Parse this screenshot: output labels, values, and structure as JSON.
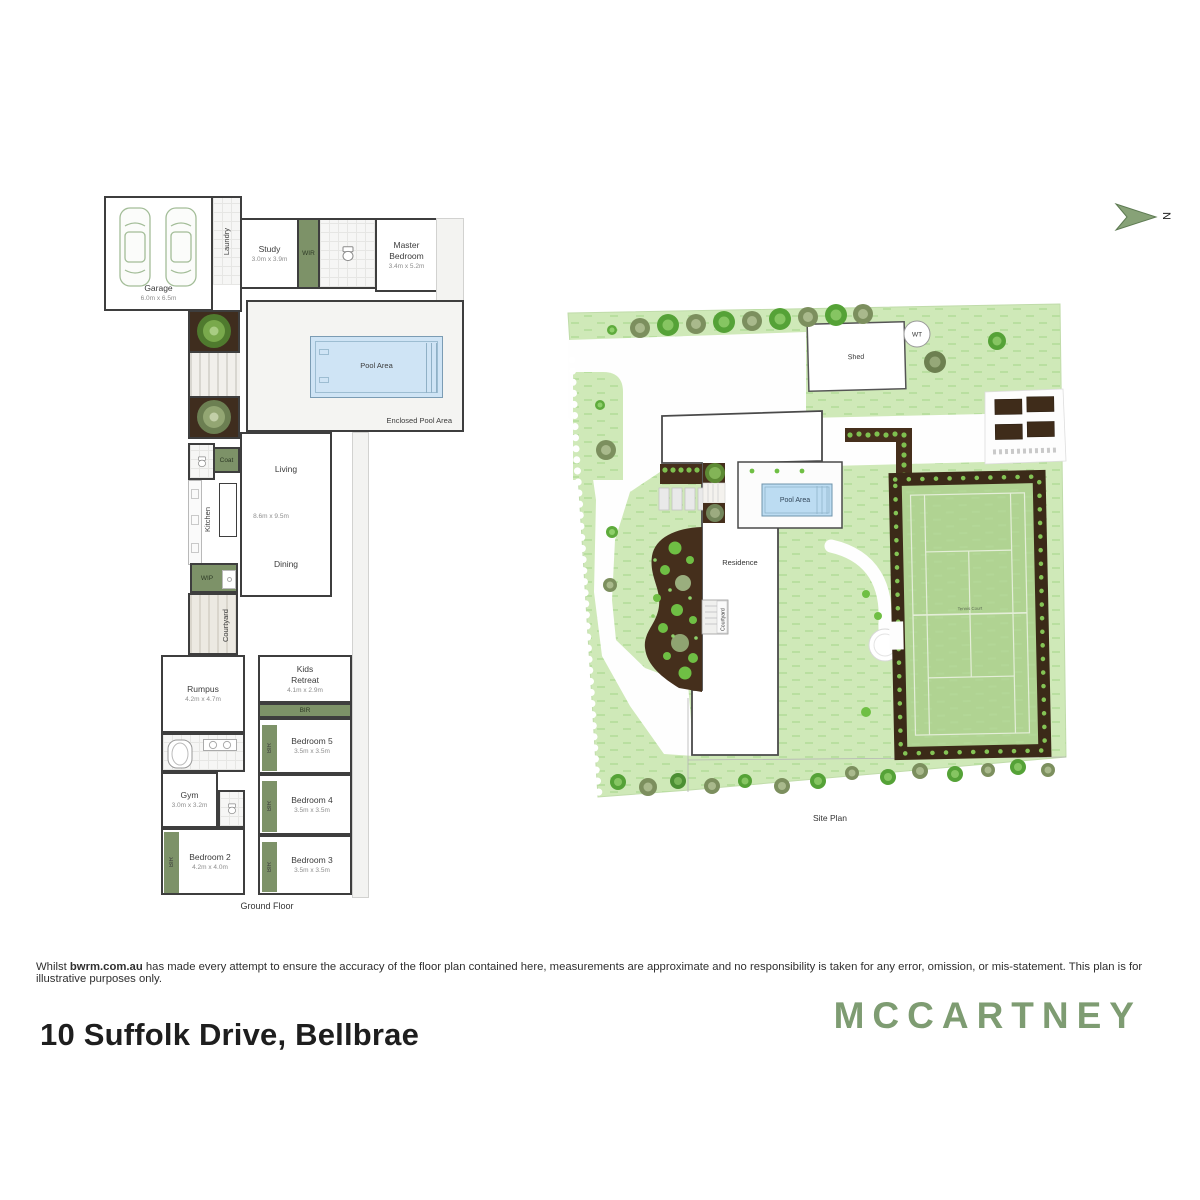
{
  "header": {
    "north_label": "N"
  },
  "floor_plan": {
    "caption": "Ground Floor",
    "labels": {
      "laundry": "Laundry",
      "wir": "WIR",
      "entry": "Entry",
      "pool": "Pool Area",
      "enclosed_pool": "Enclosed Pool Area",
      "coat": "Coat",
      "kitchen": "Kitchen",
      "wip": "WIP",
      "courtyard": "Courtyard",
      "living": "Living",
      "dining": "Dining",
      "living_dims": "8.6m x 9.5m",
      "bir": "BIR"
    },
    "rooms": {
      "garage": {
        "name": "Garage",
        "dims": "6.0m x 6.5m"
      },
      "study": {
        "name": "Study",
        "dims": "3.0m x 3.9m"
      },
      "master_bedroom": {
        "name": "Master Bedroom",
        "dims": "3.4m x 5.2m"
      },
      "rumpus": {
        "name": "Rumpus",
        "dims": "4.2m x 4.7m"
      },
      "kids_retreat": {
        "name": "Kids Retreat",
        "dims": "4.1m x 2.9m"
      },
      "bedroom5": {
        "name": "Bedroom 5",
        "dims": "3.5m x 3.5m"
      },
      "gym": {
        "name": "Gym",
        "dims": "3.0m x 3.2m"
      },
      "bedroom4": {
        "name": "Bedroom 4",
        "dims": "3.5m x 3.5m"
      },
      "bedroom2": {
        "name": "Bedroom 2",
        "dims": "4.2m x 4.0m"
      },
      "bedroom3": {
        "name": "Bedroom 3",
        "dims": "3.5m x 3.5m"
      }
    }
  },
  "site_plan": {
    "caption": "Site Plan",
    "labels": {
      "shed": "Shed",
      "water_tank": "WT",
      "pool_area": "Pool Area",
      "residence": "Residence",
      "courtyard": "Courtyard",
      "tennis_court": "Tennis Court"
    }
  },
  "footer": {
    "disclaimer_prefix": "Whilst ",
    "disclaimer_bold": "bwrm.com.au",
    "disclaimer_rest": " has made every attempt to ensure the accuracy of the floor plan contained here, measurements are approximate and no responsibility is taken for any error, omission, or mis-statement. This plan is for illustrative purposes only.",
    "address": "10 Suffolk Drive, Bellbrae",
    "brand": "MCCARTNEY"
  },
  "colors": {
    "accent_green": "#7d9268",
    "brand_green": "#7e9c72",
    "grass": "#cfe9b8",
    "garden_brown": "#452f1c",
    "pool_blue": "#cfe4f5"
  }
}
